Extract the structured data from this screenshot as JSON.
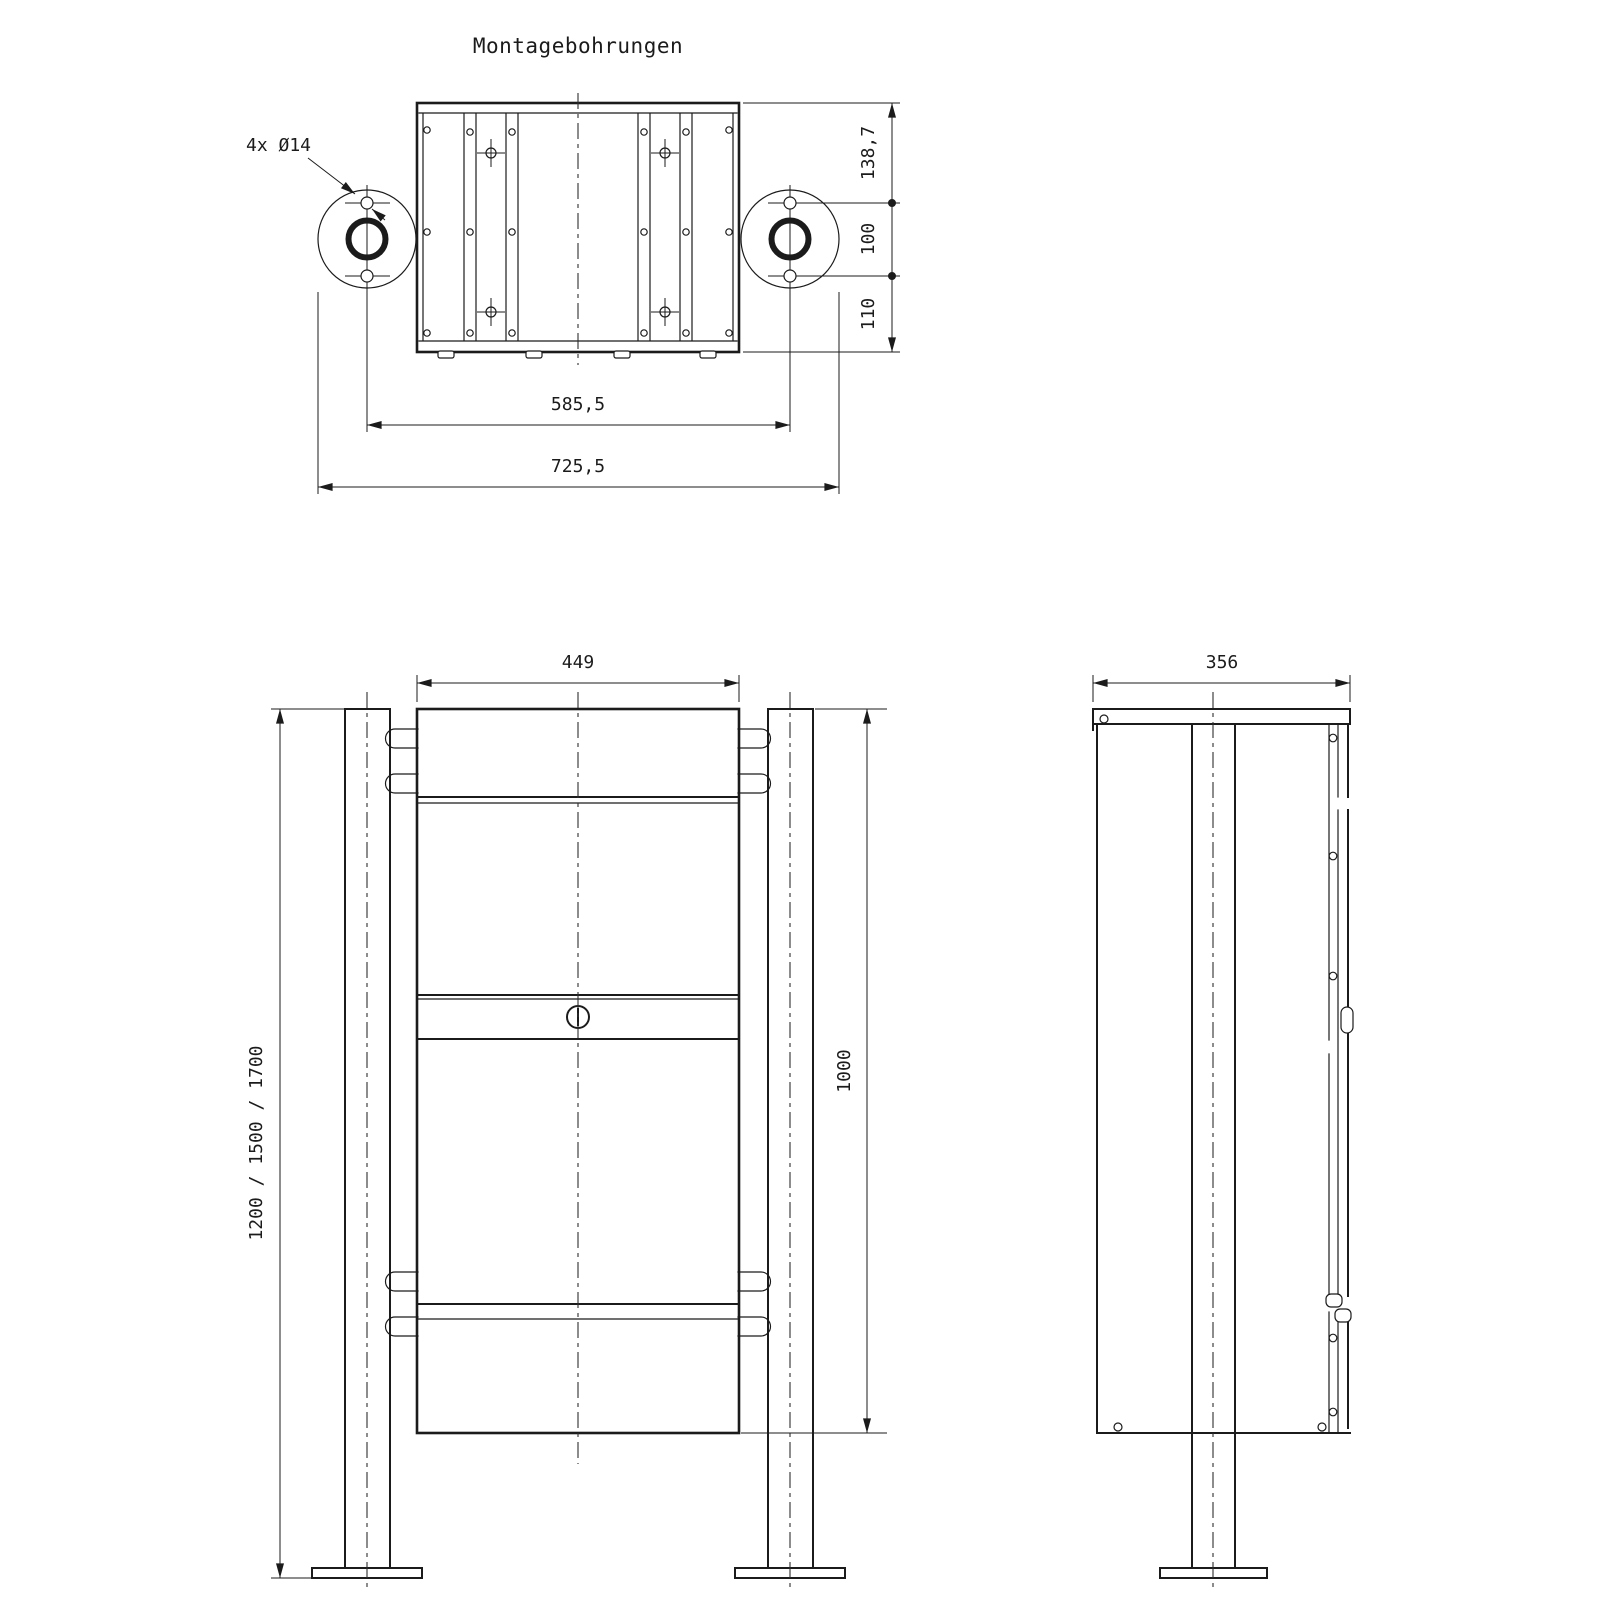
{
  "drawing": {
    "title": "Montagebohrungen",
    "line_color": "#1b1b1b",
    "background_color": "#ffffff",
    "top_view": {
      "hole_callout": "4x Ø14",
      "dims": {
        "hole_center_distance": "585,5",
        "overall_width": "725,5",
        "rear_offset": "138,7",
        "hole_spacing": "100",
        "front_offset": "110"
      }
    },
    "front_view": {
      "dims": {
        "body_width": "449",
        "post_height_options": "1200 / 1500 / 1700",
        "body_height": "1000"
      }
    },
    "side_view": {
      "dims": {
        "body_depth": "356"
      }
    }
  }
}
